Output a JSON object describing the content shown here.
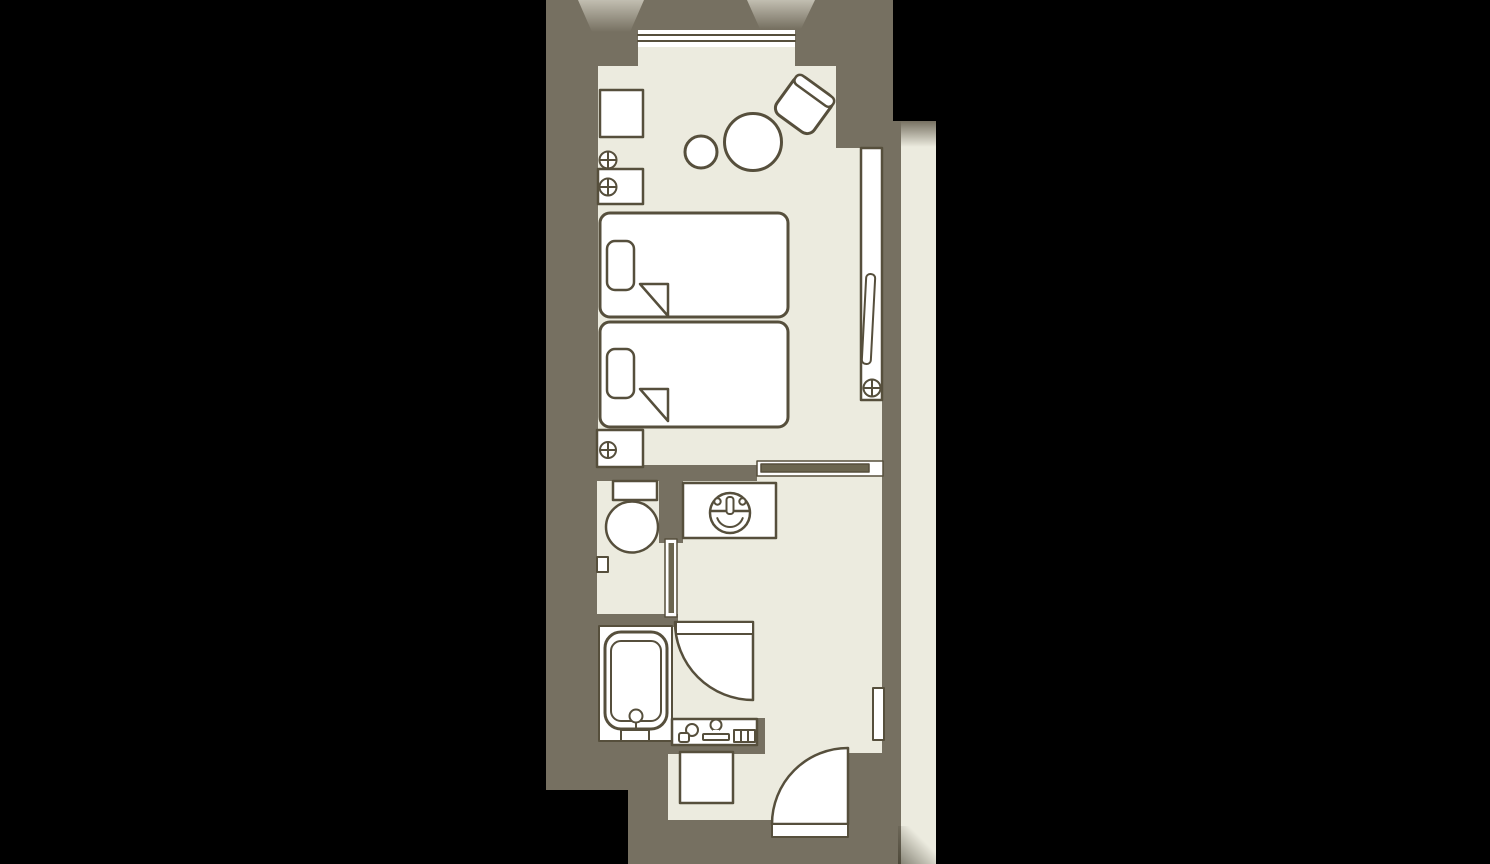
{
  "meta": {
    "kind": "floor-plan",
    "subject": "hotel twin guest room with bathroom"
  },
  "colors": {
    "canvas": "#000000",
    "wall": "#767061",
    "floor": "#ecebdf",
    "fixture": "#ffffff",
    "outline": "#564f3c",
    "door_panel": "#6b654f",
    "glow": "#f4f2e6"
  },
  "rooms": [
    {
      "label": "bedroom"
    },
    {
      "label": "toilet-room"
    },
    {
      "label": "bath-room"
    },
    {
      "label": "entry-corridor"
    }
  ],
  "fixtures": [
    {
      "label": "window"
    },
    {
      "label": "desk-cabinet"
    },
    {
      "label": "floor-lamp"
    },
    {
      "label": "nightstand-top"
    },
    {
      "label": "round-stool"
    },
    {
      "label": "round-table"
    },
    {
      "label": "armchair"
    },
    {
      "label": "twin-bed-1"
    },
    {
      "label": "twin-bed-2"
    },
    {
      "label": "nightstand-bottom"
    },
    {
      "label": "tv-console"
    },
    {
      "label": "sliding-partition"
    },
    {
      "label": "washbasin-counter"
    },
    {
      "label": "toilet"
    },
    {
      "label": "toilet-door"
    },
    {
      "label": "bathtub"
    },
    {
      "label": "bathroom-door"
    },
    {
      "label": "vanity-shelf"
    },
    {
      "label": "shoe-cabinet"
    },
    {
      "label": "entrance-door"
    },
    {
      "label": "wall-plate"
    }
  ],
  "symbols": {
    "lamp": "circled-cross",
    "washbasin": "circle-with-faucet-and-handles",
    "window": "triple-glazing-lines",
    "door_swing": "quarter-circle-arc"
  }
}
